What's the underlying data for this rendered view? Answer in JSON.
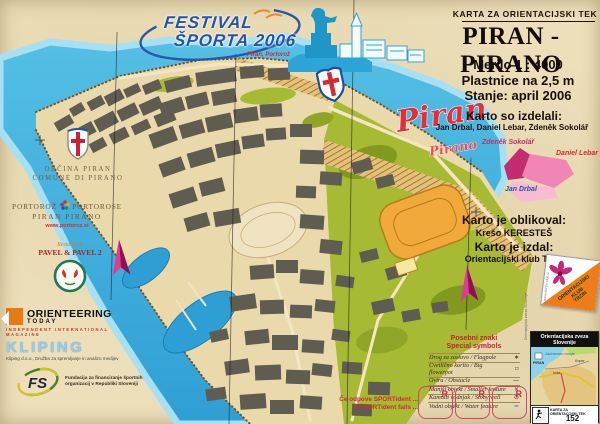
{
  "header": {
    "kicker": "KARTA ZA ORIENTACIJSKI TEK",
    "title": "PIRAN - PIRANO",
    "scale": "Merilo 1 : 4000",
    "contours": "Plastnice na 2,5 m",
    "status": "Stanje: april 2006"
  },
  "credits": {
    "authors_label": "Karto so izdelali:",
    "authors": "Jan Drbal, Daniel Lebar, Zdeněk Sokolář",
    "area_sokolar": "Zdeněk Sokolář",
    "area_lebar": "Daniel Lebar",
    "area_drbal": "Jan Drbal",
    "designer_label": "Karto je oblikoval:",
    "designer": "Krešo KERESTEŠ",
    "publisher_label": "Karto je izdal:",
    "publisher": "Orientacijski klub Trzin"
  },
  "club": {
    "line1": "ORIENTACIJSKI",
    "line2": "KLUB",
    "line3": "TRZIN",
    "site": "www.oktrzin-klub.si"
  },
  "map_art": {
    "title": "Piran",
    "subtitle": "Pirano"
  },
  "legend": {
    "title_sl": "Posebni znaki",
    "title_en": "Special symbols",
    "rows": [
      {
        "label": "Drog za zastavo / Flagpole",
        "symbol": "∗"
      },
      {
        "label": "Cvetlično korito / Big flowerpot",
        "symbol": "▫"
      },
      {
        "label": "Ovira / Obstacle",
        "symbol": "—"
      },
      {
        "label": "Manjši objekt / Smaller feature",
        "symbol": "×"
      },
      {
        "label": "Kamniti vodnjak / Stony well",
        "symbol": "⊙"
      },
      {
        "label": "Vodni objekt / Water feature",
        "symbol": "≈"
      }
    ]
  },
  "sportident": {
    "line1": "Če odpove SPORTident ...",
    "line2": "If SPORTident fails ...",
    "r": "R"
  },
  "ozs": {
    "title": "Orientacijska zveza Slovenije",
    "side": "Orientacijska zveza Slovenije",
    "sea": "Jadransko morje",
    "place1": "PIRAN",
    "place2": "Izola",
    "place3": "Koper",
    "footer": "KARTA ZA ORIENTACIJSKI TEK",
    "number": "152"
  },
  "sponsors": {
    "festival": {
      "line1": "FESTIVAL",
      "line2": "ŠPORTA 2006",
      "sub": "Piran, Portorož"
    },
    "obcina": {
      "line1": "OBČINA PIRAN",
      "line2": "COMUNE DI PIRANO"
    },
    "portoroz": {
      "a": "PORTOROŽ",
      "b": "PORTOROSE",
      "line2": "PIRAN  PIRANO",
      "url": "www.portoroz.si"
    },
    "pavel": {
      "kicker": "Restaurant",
      "name": "PAVEL & PAVEL 2"
    },
    "ot": {
      "name": "ORIENTEERING",
      "sub": "TODAY",
      "tag": "INDEPENDENT INTERNATIONAL MAGAZINE"
    },
    "kliping": {
      "name": "KLIPING",
      "tag": "Kliping d.o.o., Družba za spremljanje in analizo medijev"
    },
    "fs": {
      "abbr": "FS",
      "text": "Fundacija za financiranje športnih organizacij v Republiki Sloveniji"
    }
  },
  "colors": {
    "parchment": "#ecdfba",
    "sea": "#35a9db",
    "magenta": "#cf1978",
    "red": "#d42b33",
    "green": "#a6ba33",
    "building": "#5f5c52",
    "stadium": "#f2a93c"
  }
}
